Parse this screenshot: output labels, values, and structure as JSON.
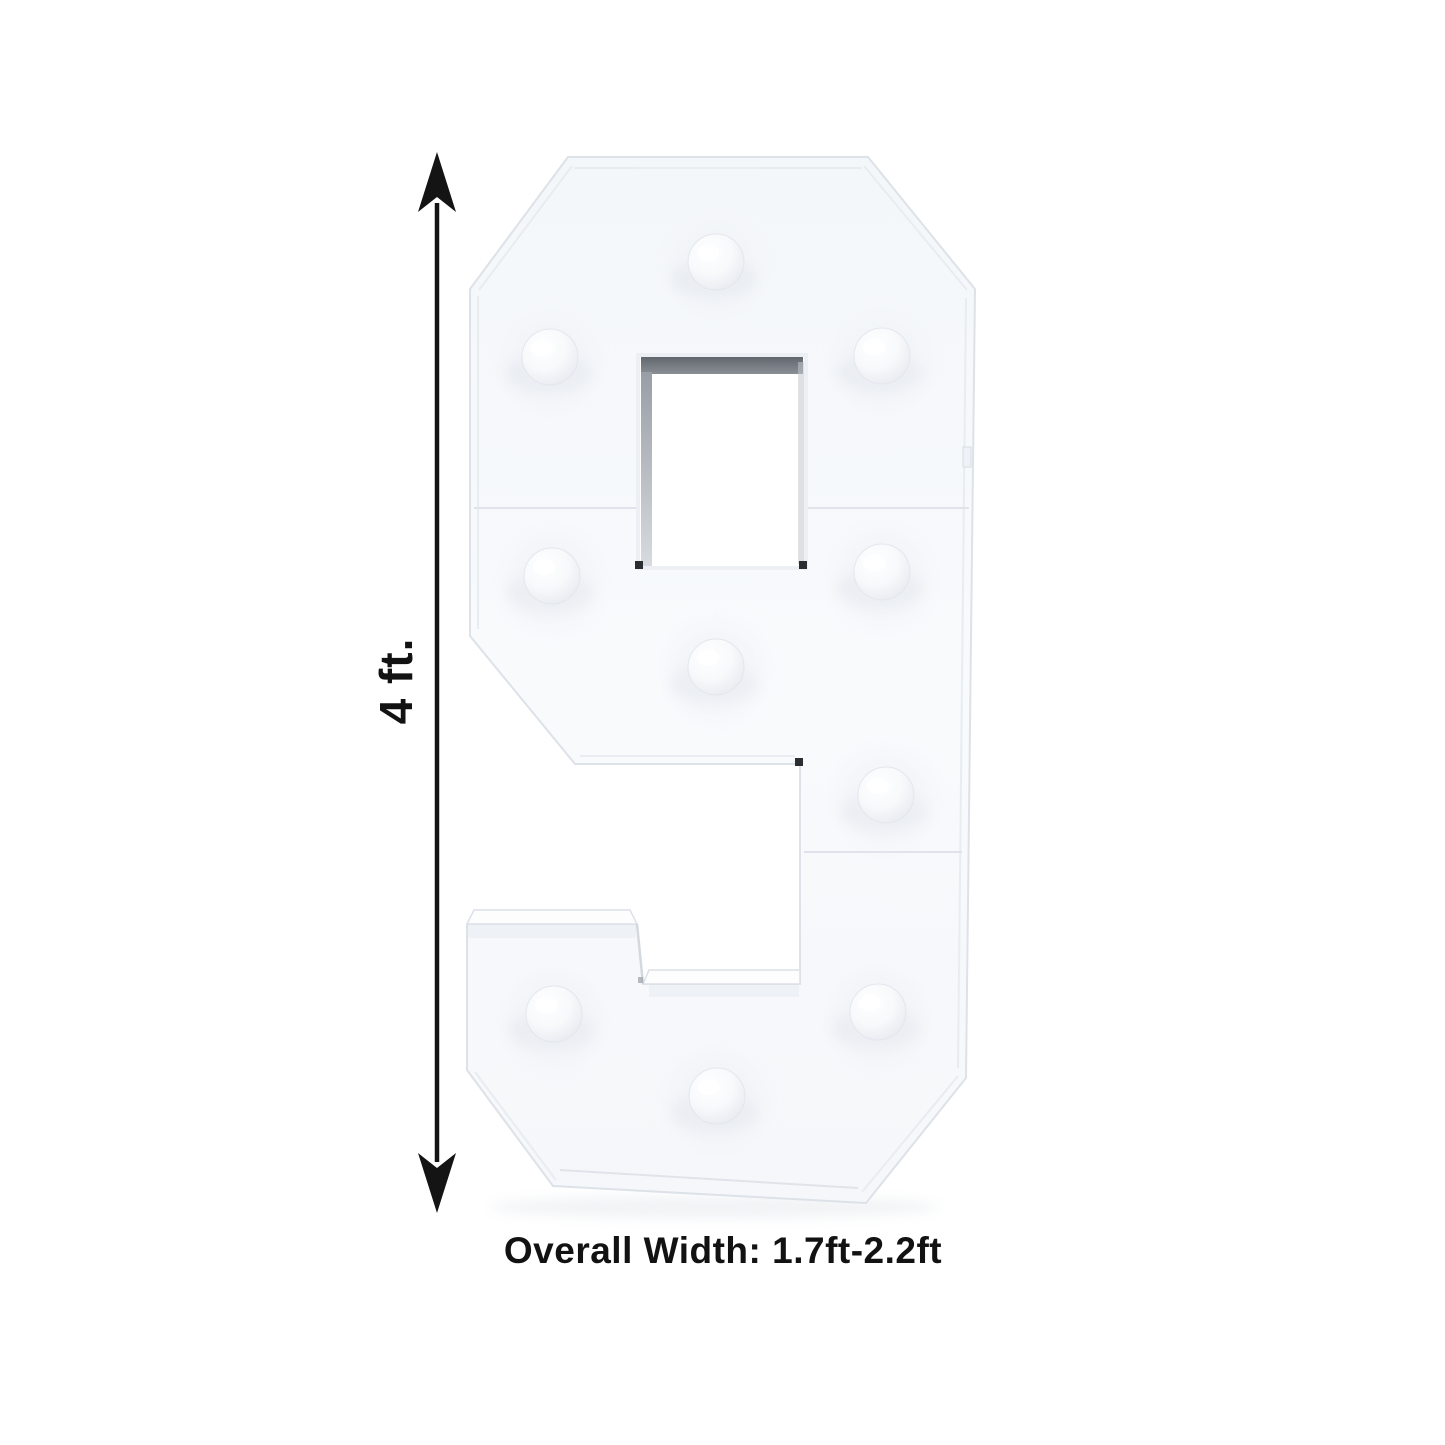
{
  "figure": {
    "digit": "9",
    "bulb_count": 10,
    "description": "White marquee mosaic number 9 frame with unlit push-in bulbs, shown with height and width dimension annotations"
  },
  "dimensions": {
    "height_label": "4 ft.",
    "width_label": "Overall Width: 1.7ft-2.2ft"
  },
  "colors": {
    "annotation_black": "#141414",
    "background": "#ffffff",
    "panel_white": "#f7f9fc",
    "panel_edge": "#dde2e9",
    "window_shadow_gray": "#70757c"
  }
}
